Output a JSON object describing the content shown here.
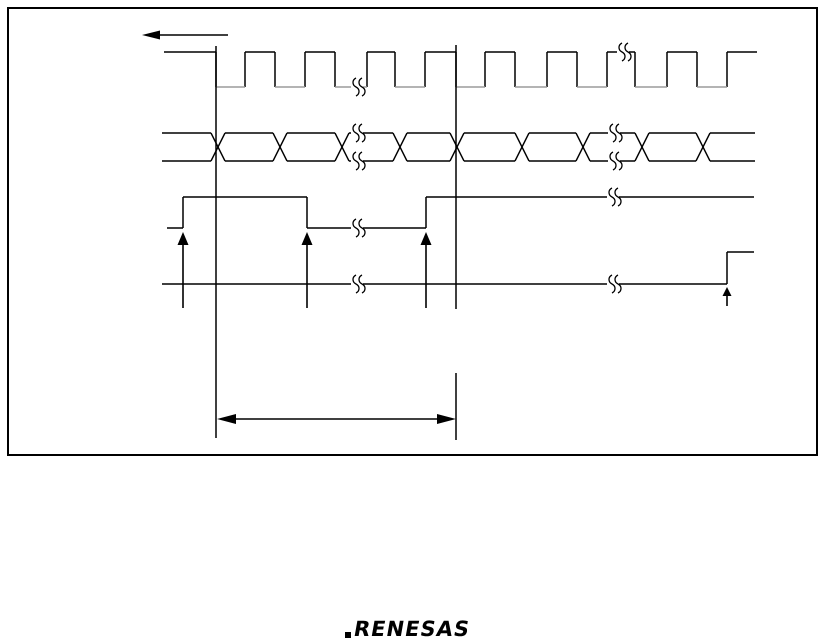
{
  "page": {
    "width": 821,
    "height": 643,
    "background": "#ffffff"
  },
  "colors": {
    "line": "#000000",
    "clock_low": "#9b9b9b",
    "white": "#ffffff"
  },
  "logo": {
    "text": "RENESAS"
  },
  "diagram": {
    "box": {
      "x": 8,
      "y": 8,
      "w": 809,
      "h": 447,
      "stroke_w": 2
    },
    "left_arrow": {
      "y": 35,
      "tip_x": 142,
      "tail_x": 228,
      "head_l": 18,
      "head_h": 9
    },
    "signals": [
      {
        "name": "clock",
        "type": "step",
        "high_y": 52,
        "low_y": 87,
        "start_x": 164,
        "start_level": "high",
        "transitions": [
          216,
          245,
          275,
          305,
          335,
          367,
          395,
          425,
          456,
          485,
          515,
          547,
          577,
          607,
          635,
          667,
          697,
          727
        ],
        "end_x": 757,
        "breaks": [
          357,
          623
        ],
        "low_color": "clock_low"
      },
      {
        "name": "data-bus",
        "type": "bus",
        "high_y": 133,
        "low_y": 161,
        "start_x": 162,
        "end_x": 755,
        "half_w": 7,
        "crossings": [
          218,
          280,
          342,
          400,
          457,
          522,
          583,
          642,
          703
        ],
        "breaks": [
          357,
          614
        ]
      },
      {
        "name": "strobe",
        "type": "step",
        "high_y": 197,
        "low_y": 228,
        "start_x": 167,
        "start_level": "low",
        "transitions": [
          183,
          307,
          426
        ],
        "end_x": 754,
        "breaks": [
          357,
          613
        ]
      },
      {
        "name": "output",
        "type": "step",
        "high_y": 252,
        "low_y": 284,
        "start_x": 162,
        "start_level": "low",
        "transitions": [
          727
        ],
        "end_x": 754,
        "breaks": [
          357,
          613
        ]
      }
    ],
    "vlines": [
      {
        "x": 216,
        "segs": [
          [
            46,
            438
          ]
        ]
      },
      {
        "x": 456,
        "segs": [
          [
            45,
            309
          ],
          [
            373,
            440
          ]
        ]
      }
    ],
    "up_arrows": [
      {
        "x": 183,
        "tip_y": 232,
        "base_y": 308,
        "hw": 5.5,
        "hh": 13
      },
      {
        "x": 307,
        "tip_y": 232,
        "base_y": 308,
        "hw": 5.5,
        "hh": 13
      },
      {
        "x": 426,
        "tip_y": 232,
        "base_y": 308,
        "hw": 5.5,
        "hh": 13
      },
      {
        "x": 727,
        "tip_y": 287,
        "base_y": 306,
        "hw": 4.5,
        "hh": 9
      }
    ],
    "measure_arrow": {
      "y": 419,
      "x1": 217,
      "x2": 456,
      "head_l": 19,
      "head_h": 10
    },
    "break_style": {
      "gap_w": 12,
      "h": 18
    }
  }
}
